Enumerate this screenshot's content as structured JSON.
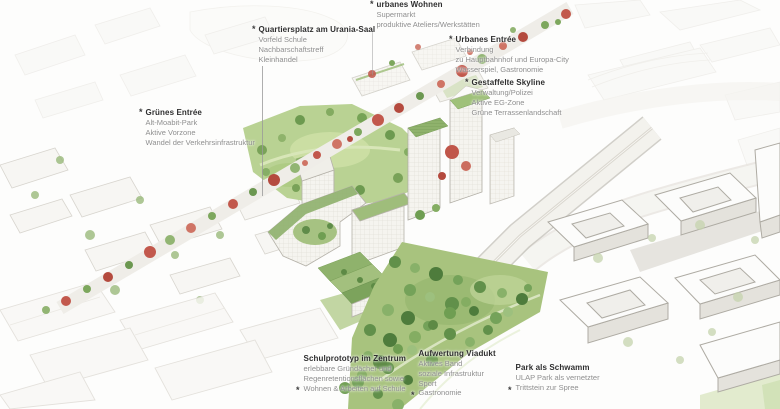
{
  "callouts": [
    {
      "marker": "*",
      "title": "Quartiersplatz am Urania-Saal",
      "lines": [
        "Vorfeld Schule",
        "Nachbarschaftstreff",
        "Kleinhandel"
      ]
    },
    {
      "marker": "*",
      "title": "urbanes Wohnen",
      "lines": [
        "Supermarkt",
        "produktive Ateliers/Werkstätten"
      ]
    },
    {
      "marker": "*",
      "title": "Urbanes Entrée",
      "lines": [
        "Verbindung",
        "zu Hauptbahnhof und Europa-City",
        "Wasserspiel, Gastronomie"
      ]
    },
    {
      "marker": "*",
      "title": "Gestaffelte Skyline",
      "lines": [
        "Verwaltung/Polizei",
        "Aktive EG-Zone",
        "Grüne Terrassenlandschaft"
      ]
    },
    {
      "marker": "*",
      "title": "Grünes Entrée",
      "lines": [
        "Alt-Moabit-Park",
        "Aktive Vorzone",
        "Wandel der Verkehrsinfrastruktur"
      ]
    },
    {
      "marker": "*",
      "title": "Schulprototyp im Zentrum",
      "lines": [
        "erlebbare Gründächer und",
        "Regenretentionsflächen sowie",
        "Wohnen & Arbeiten auf Schule"
      ]
    },
    {
      "marker": "*",
      "title": "Aufwertung Viadukt",
      "lines": [
        "Aktives Band",
        "soziale Infrastruktur",
        "Sport",
        "Gastronomie"
      ]
    },
    {
      "marker": "*",
      "title": "Park als Schwamm",
      "lines": [
        "ULAP Park als vernetzter",
        "Trittstein zur Spree"
      ]
    }
  ],
  "colors": {
    "title_text": "#2e2e2e",
    "body_text": "#8f8f8f",
    "park_green": "#b9d293",
    "dense_park_green": "#a8c37e",
    "roof_green": "#8eb06b",
    "tree_green": "#6f9e52",
    "tree_red": "#c2584c",
    "building_fill": "#f5f4ef",
    "viaduct_gray": "#f2f1ec"
  }
}
